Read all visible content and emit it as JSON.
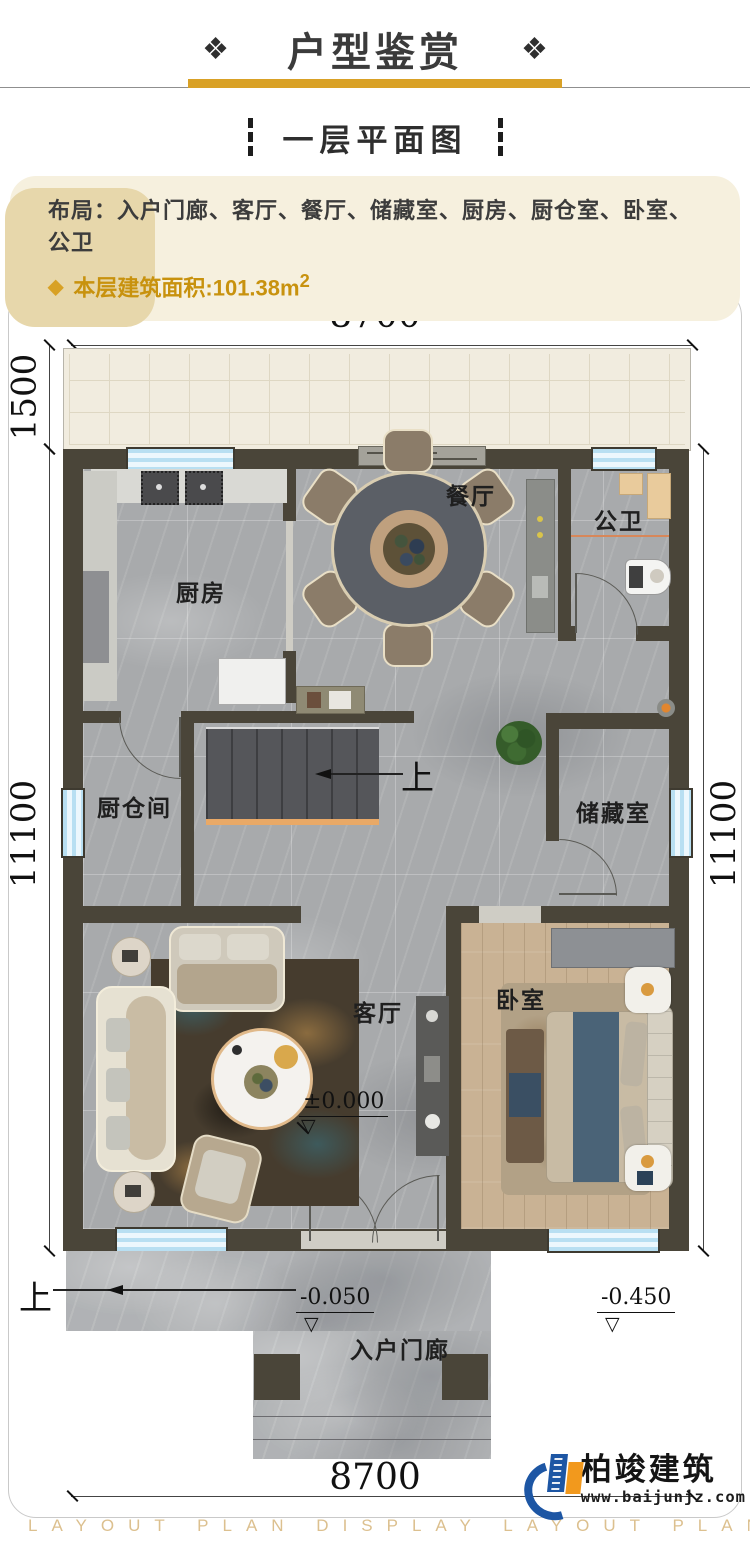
{
  "colors": {
    "accent_gold": "#d9a126",
    "gold_text": "#c8920e",
    "wall": "#4a4539",
    "window_blue": "#b8dff2",
    "logo_blue": "#1d56a4",
    "logo_orange": "#f2991d"
  },
  "header": {
    "decor_left": "❖",
    "title": "户型鉴赏",
    "decor_right": "❖"
  },
  "subtitle": {
    "text": "一层平面图"
  },
  "info": {
    "layout_label": "布局：",
    "layout_items": "入户门廊、客厅、餐厅、储藏室、厨房、厨仓室、卧室、公卫",
    "bullet": "◆",
    "area_text": "本层建筑面积:101.38m",
    "area_sup": "2"
  },
  "plan": {
    "dims": {
      "width_top": "8700",
      "terrace_depth": "1500",
      "height_left": "11100",
      "height_right": "11100",
      "width_bottom": "8700"
    },
    "rooms": {
      "dining": "餐厅",
      "bath": "公卫",
      "kitchen": "厨房",
      "pantry": "厨仓间",
      "storage": "储藏室",
      "living": "客厅",
      "bedroom": "卧室",
      "porch": "入户门廊"
    },
    "levels": {
      "living": "±0.000",
      "porch": "-0.050",
      "outdoor": "-0.450"
    },
    "elev_symbol": "▽",
    "stair_up": "上",
    "porch_up": "上"
  },
  "footer": {
    "brand": "柏竣建筑",
    "website": "www.baijunjz.com",
    "watermark": "LAYOUT PLAN DISPLAY LAYOUT PLAN DISPLAY"
  }
}
